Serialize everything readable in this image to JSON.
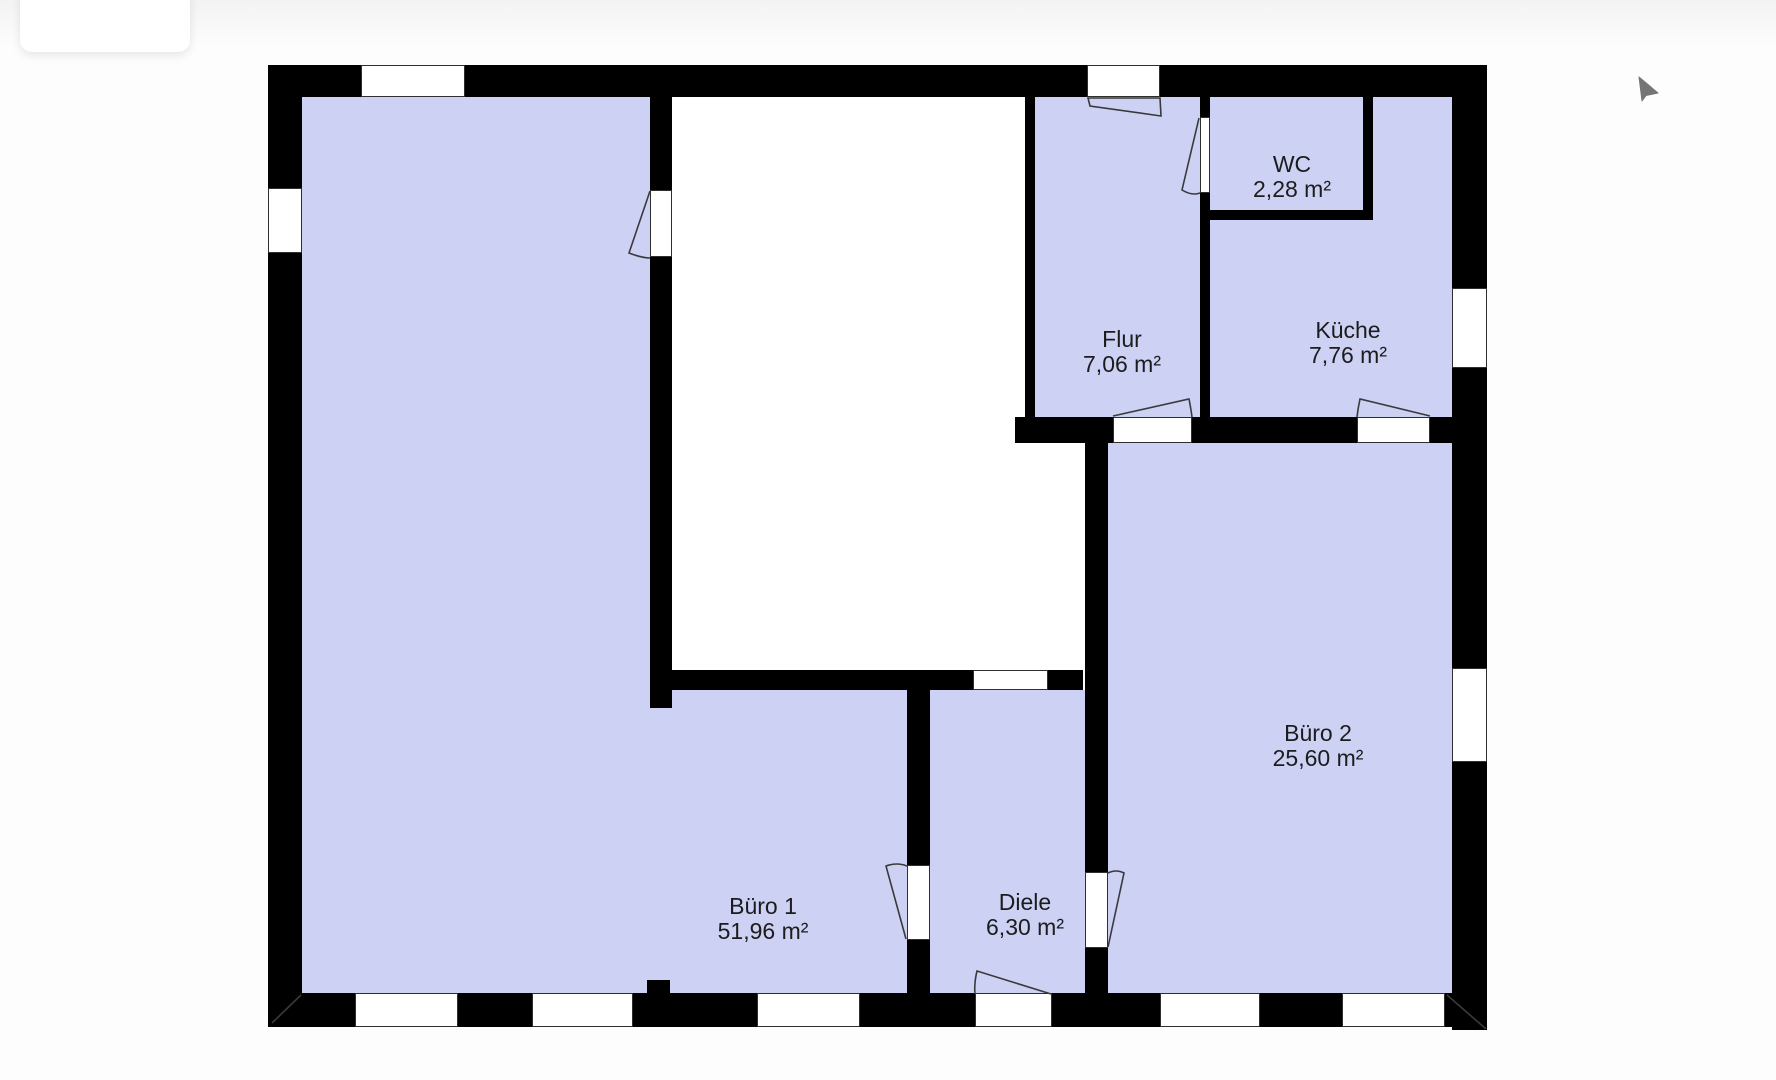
{
  "floorplan": {
    "wall_color": "#000000",
    "room_fill_color": "#cdd1f4",
    "rooms": [
      {
        "id": "buero1",
        "name": "Büro 1",
        "area": "51,96 m²"
      },
      {
        "id": "diele",
        "name": "Diele",
        "area": "6,30 m²"
      },
      {
        "id": "buero2",
        "name": "Büro 2",
        "area": "25,60 m²"
      },
      {
        "id": "flur",
        "name": "Flur",
        "area": "7,06 m²"
      },
      {
        "id": "wc",
        "name": "WC",
        "area": "2,28 m²"
      },
      {
        "id": "kueche",
        "name": "Küche",
        "area": "7,76 m²"
      }
    ]
  },
  "cursor": {
    "type": "arrow-pointer",
    "color": "#757575"
  }
}
